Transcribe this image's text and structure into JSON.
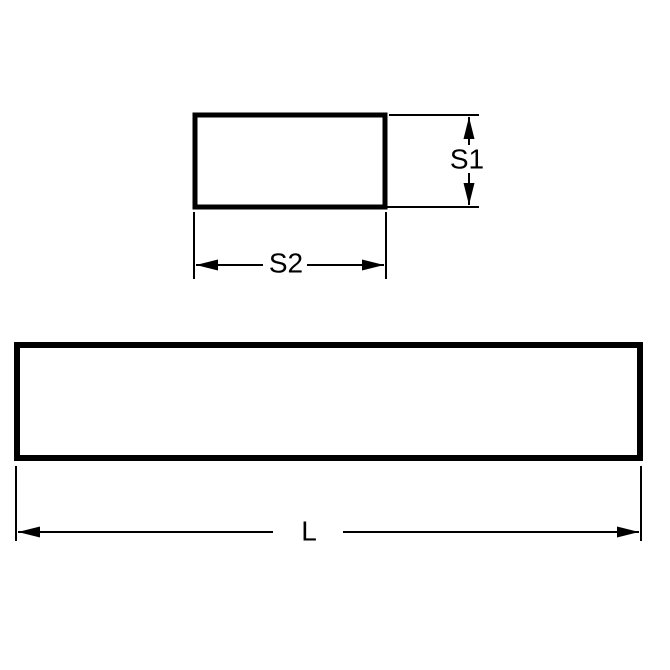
{
  "page": {
    "background_color": "#ffffff"
  },
  "diagram": {
    "line_color": "#000000",
    "cross_section": {
      "height_label": "S1",
      "width_label": "S2"
    },
    "side_view": {
      "length_label": "L"
    }
  }
}
